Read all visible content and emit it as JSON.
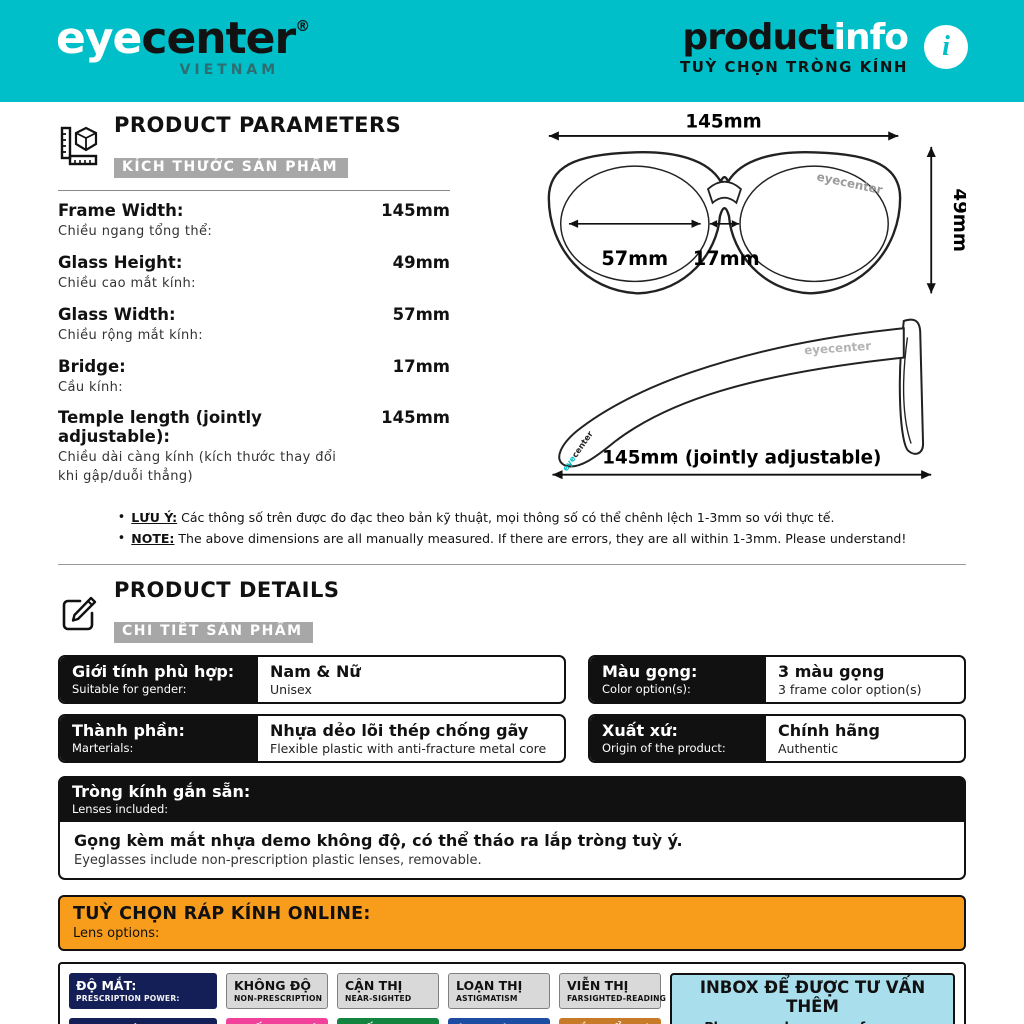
{
  "colors": {
    "teal": "#00bfc8",
    "orange": "#f89c1c",
    "navy": "#151f57",
    "pink": "#f0419b",
    "green": "#13843f",
    "blue": "#1c4da3",
    "brown": "#c77b28",
    "light_blue": "#a9dfec",
    "badge_gray": "#d9d9d9",
    "black": "#111111"
  },
  "header": {
    "logo_eye": "eye",
    "logo_center": "center",
    "logo_reg": "®",
    "logo_country": "VIETNAM",
    "brand_black": "product",
    "brand_white": "info",
    "subtitle": "TUỲ CHỌN TRÒNG KÍNH",
    "info_glyph": "i"
  },
  "parameters": {
    "title": "PRODUCT PARAMETERS",
    "subtitle": "KÍCH THƯỚC SẢN PHẨM",
    "rows": [
      {
        "en": "Frame Width:",
        "vi": "Chiều ngang tổng thể:",
        "value": "145mm"
      },
      {
        "en": "Glass Height:",
        "vi": "Chiều cao mắt kính:",
        "value": "49mm"
      },
      {
        "en": "Glass Width:",
        "vi": "Chiều rộng mắt kính:",
        "value": "57mm"
      },
      {
        "en": "Bridge:",
        "vi": "Cầu kính:",
        "value": "17mm"
      },
      {
        "en": "Temple length (jointly adjustable):",
        "vi": "Chiều dài càng kính (kích thước thay đổi khi gập/duỗi thẳng)",
        "value": "145mm"
      }
    ],
    "notes": [
      {
        "label": "LƯU Ý:",
        "text": "Các thông số trên được đo đạc theo bản kỹ thuật, mọi thông số có thể chênh lệch 1-3mm so với thực tế."
      },
      {
        "label": "NOTE:",
        "text": "The above dimensions are all manually measured. If there are errors, they are all within 1-3mm. Please understand!"
      }
    ]
  },
  "diagram": {
    "front": {
      "top": "145mm",
      "right": "49mm",
      "lens": "57mm",
      "bridge": "17mm",
      "watermark": "eyecenter"
    },
    "side": {
      "bottom": "145mm (jointly adjustable)",
      "watermark": "eyecenter",
      "tip_eye": "eye",
      "tip_center": "center"
    }
  },
  "details": {
    "title": "PRODUCT DETAILS",
    "subtitle": "CHI TIẾT SẢN PHẨM",
    "cells": [
      {
        "label_vi": "Giới tính phù hợp:",
        "label_en": "Suitable for gender:",
        "value_vi": "Nam & Nữ",
        "value_en": "Unisex"
      },
      {
        "label_vi": "Màu gọng:",
        "label_en": "Color option(s):",
        "value_vi": "3 màu gọng",
        "value_en": "3 frame color option(s)"
      },
      {
        "label_vi": "Thành phần:",
        "label_en": "Marterials:",
        "value_vi": "Nhựa dẻo lõi thép chống gãy",
        "value_en": "Flexible plastic with anti-fracture metal core"
      },
      {
        "label_vi": "Xuất xứ:",
        "label_en": "Origin of the product:",
        "value_vi": "Chính hãng",
        "value_en": "Authentic"
      }
    ],
    "lenses": {
      "label_vi": "Tròng kính gắn sẵn:",
      "label_en": "Lenses included:",
      "value_vi": "Gọng kèm mắt nhựa demo không độ, có thể tháo ra lắp tròng tuỳ ý.",
      "value_en": "Eyeglasses include non-prescription plastic lenses, removable."
    }
  },
  "lens_options": {
    "title": "TUỲ CHỌN RÁP KÍNH ONLINE:",
    "subtitle": "Lens options:",
    "badges": [
      {
        "title": "ĐỘ MẮT:",
        "sub": "PRESCRIPTION POWER:"
      },
      {
        "title": "KHÔNG ĐỘ",
        "sub": "NON-PRESCRIPTION"
      },
      {
        "title": "CẬN THỊ",
        "sub": "NEAR-SIGHTED"
      },
      {
        "title": "LOẠN THỊ",
        "sub": "ASTIGMATISM"
      },
      {
        "title": "VIỄN THỊ",
        "sub": "FARSIGHTED-READING"
      },
      {
        "title": "LOẠI TRÒNG:",
        "sub": "LENS OPTIONS:"
      },
      {
        "title": "CHỐNG XƯỚC",
        "sub": "ANTI-SCRATCH LENSES"
      },
      {
        "title": "CHỐNG UV",
        "sub": "UV400 LENSES"
      },
      {
        "title": "ÁNH SÁNG XANH",
        "sub": "BLUECONTROL LENSES"
      },
      {
        "title": "MẮT ĐỔI MÀU",
        "sub": "PHOTOCHROMIC LENSES"
      }
    ],
    "inbox": {
      "title": "INBOX ĐỂ ĐƯỢC TƯ VẤN THÊM",
      "sub": "Please send message for more information"
    }
  }
}
